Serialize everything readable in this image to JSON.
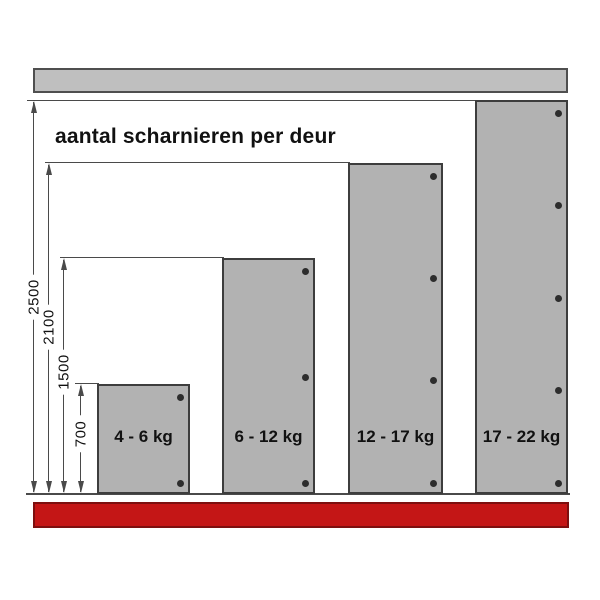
{
  "title": "aantal scharnieren per deur",
  "doors": [
    {
      "label": "4 - 6 kg",
      "hinges": 2,
      "door_height_mm": 700
    },
    {
      "label": "6 - 12 kg",
      "hinges": 3,
      "door_height_mm": 1500
    },
    {
      "label": "12 - 17 kg",
      "hinges": 4,
      "door_height_mm": 2100
    },
    {
      "label": "17 - 22 kg",
      "hinges": 5,
      "door_height_mm": 2500
    }
  ],
  "dimensions": [
    {
      "value": "2500"
    },
    {
      "value": "2100"
    },
    {
      "value": "1500"
    },
    {
      "value": "700"
    }
  ],
  "colors": {
    "door_fill": "#b2b2b2",
    "door_border": "#3d3d3d",
    "rail_fill": "#bfbfbf",
    "rail_border": "#4f4f4f",
    "line": "#4a4a4a",
    "hinge_dot": "#2d2d2d",
    "floor_fill": "#c41616",
    "floor_border": "#7e0f0f",
    "text": "#111111"
  }
}
